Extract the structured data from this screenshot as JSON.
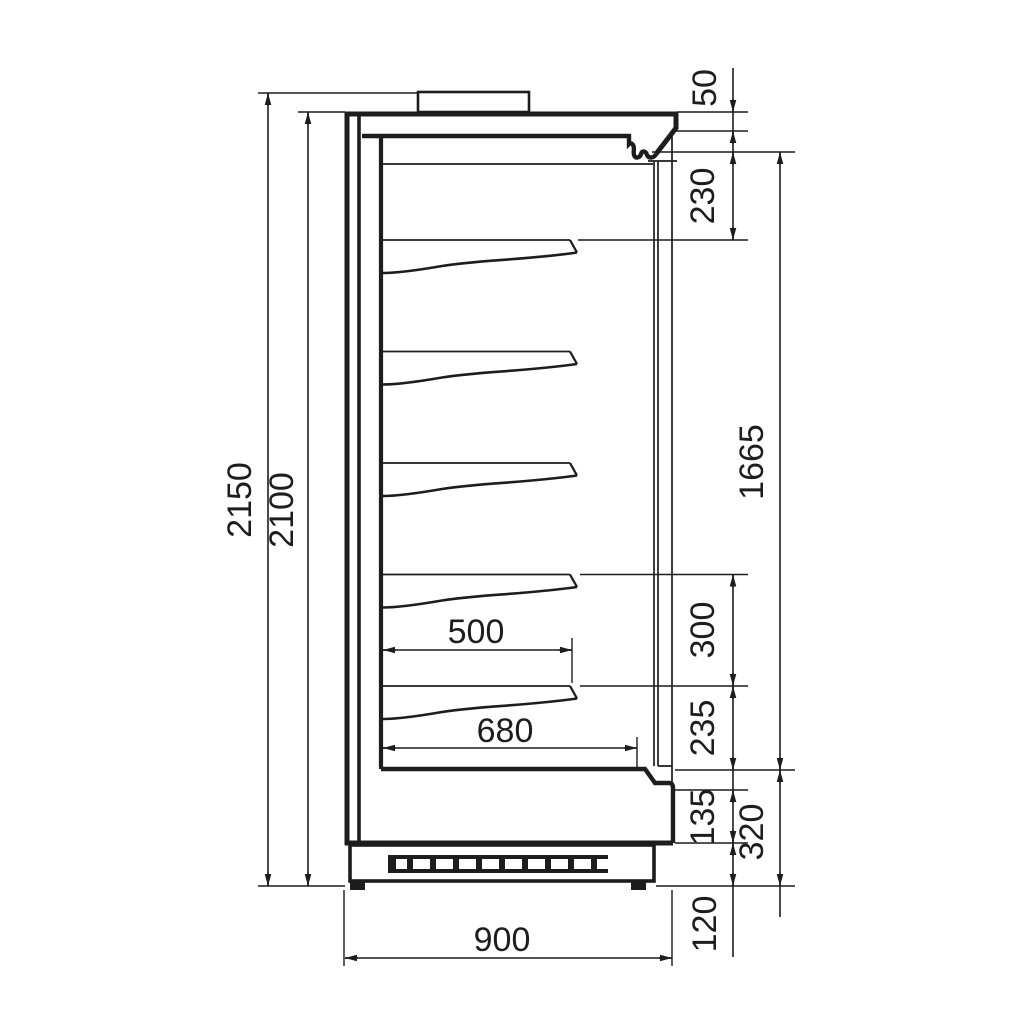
{
  "drawing_title": "multideck-display-cabinet-side-section",
  "colors": {
    "line": "#1d1d1d",
    "background": "#ffffff"
  },
  "dims": {
    "overall_height": "2150",
    "cabinet_height": "2100",
    "canopy_band": "50",
    "canopy_to_first_shelf": "230",
    "display_opening_height": "1665",
    "shelf_spacing": "300",
    "last_shelf_to_deck": "235",
    "front_lower_band": "135",
    "base_height": "320",
    "plinth_height": "120",
    "shelf_depth": "500",
    "deck_depth": "680",
    "overall_depth": "900"
  }
}
